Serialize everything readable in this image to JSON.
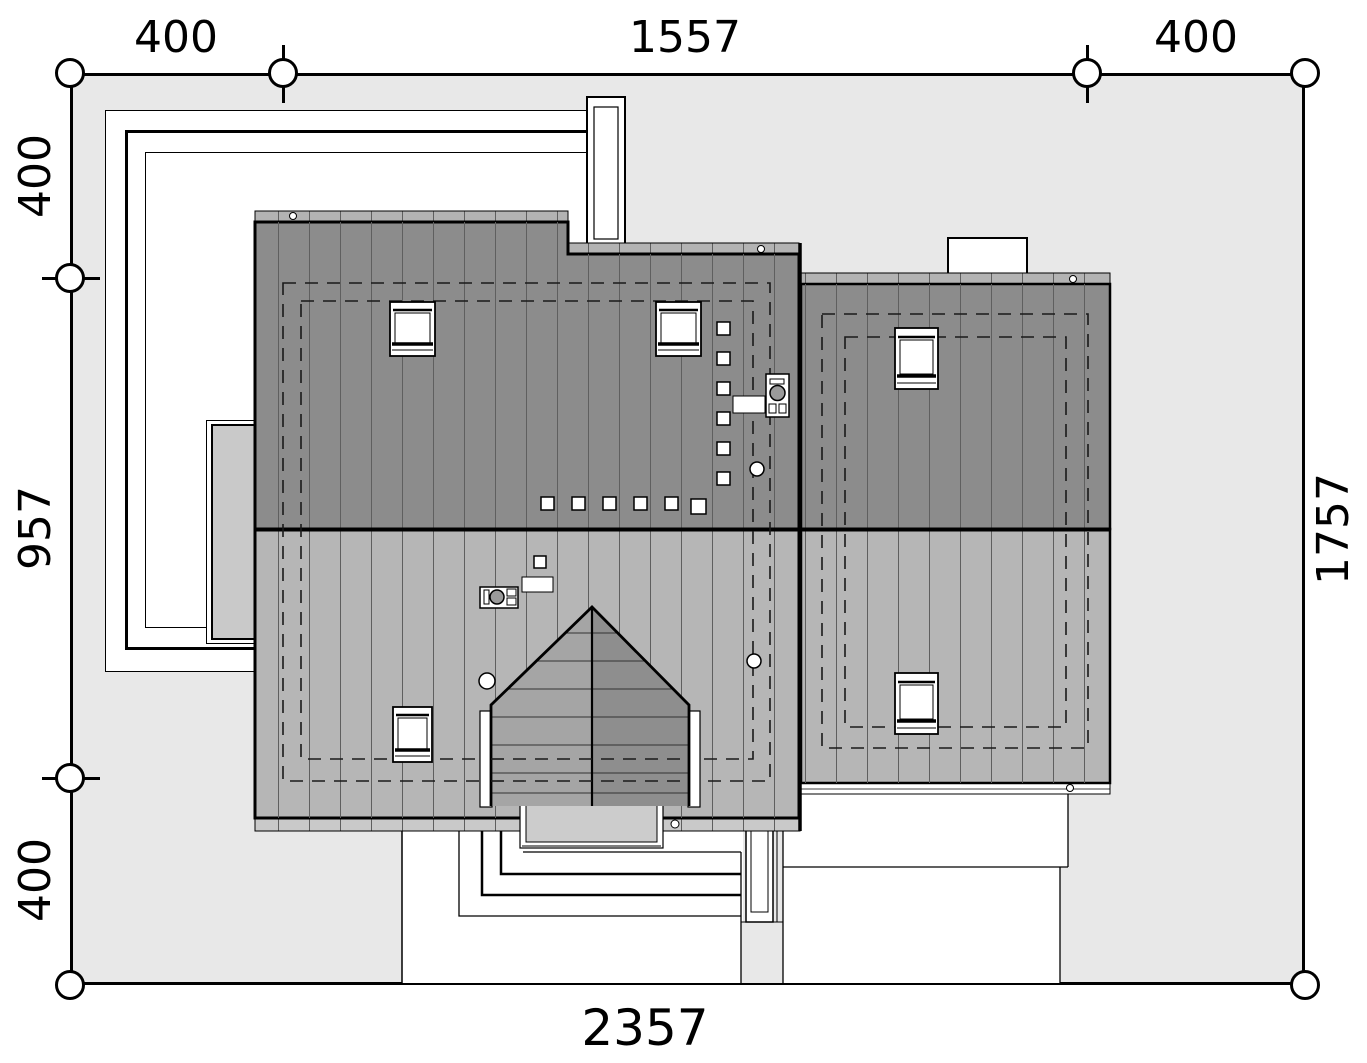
{
  "drawing_type": "site-plan-roof-view",
  "dimensions": {
    "top": [
      "400",
      "1557",
      "400"
    ],
    "left": [
      "400",
      "957",
      "400"
    ],
    "right": [
      "1757"
    ],
    "bottom": [
      "2357"
    ]
  },
  "colors": {
    "plot": "#e8e8e8",
    "walkway": "#ffffff",
    "roof_dark": "#8c8c8c",
    "roof_light": "#b6b6b6",
    "eave_top": "#b3b3b3",
    "eave_bottom": "#c9c9c9",
    "dormer_left": "#a5a5a5",
    "dormer_right": "#8e8e8e",
    "porch": "#cccccc",
    "awning": "#c9c9c9",
    "line": "#000000"
  }
}
